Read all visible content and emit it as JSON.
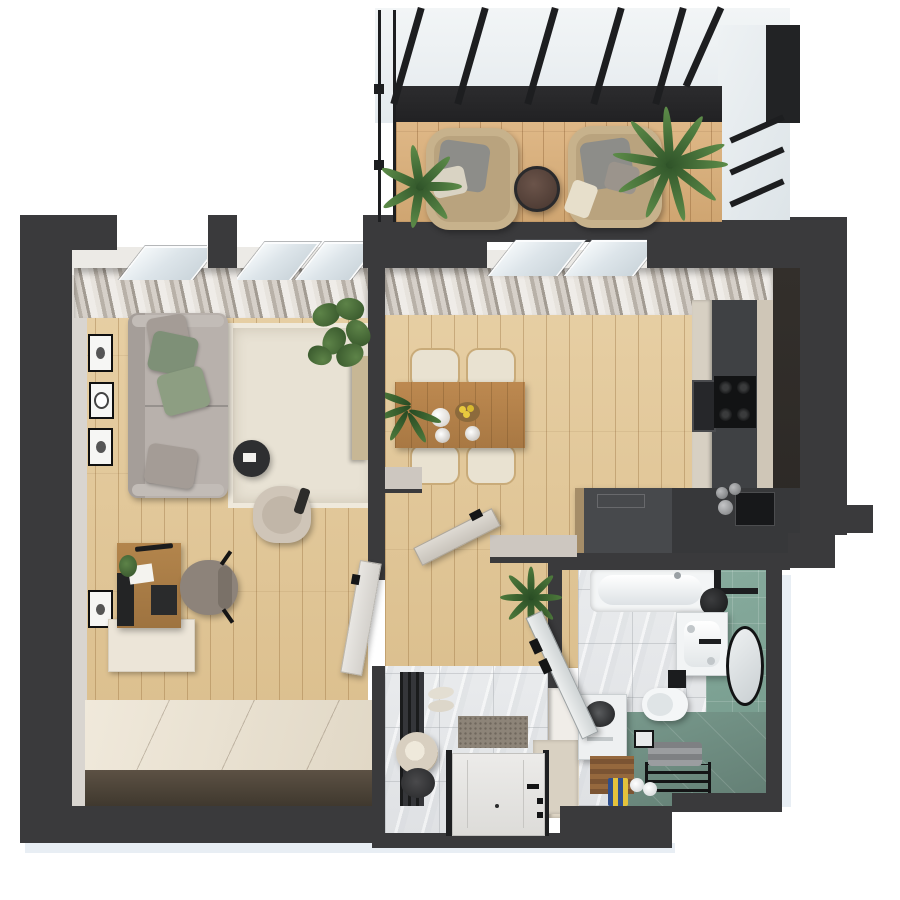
{
  "scene": {
    "type": "3d-top-down-floor-plan-render",
    "description_labels": {
      "balcony": "Balcony terrace with glazed pergola",
      "living": "Living room",
      "dining": "Dining area and kitchen",
      "hall": "Entrance hallway",
      "bath": "Bathroom",
      "study": "Work corner with platform"
    }
  },
  "palette": {
    "wall": "#3a3a3c",
    "wallLight": "#d9d5d0",
    "rug": "#e8e2d4",
    "sofa": "#b8b1ac",
    "pillowGreen": "#7e9077",
    "pillowGreen2": "#8d9e82",
    "pillowGray": "#a49c96",
    "diningTable": "#b5824a",
    "chairCream": "#e9e2d1",
    "cabinetDark": "#3f4144",
    "cabinetBeige": "#d7d0c3",
    "counterDark": "#37383a",
    "islandTop": "#47494c",
    "doorLight": "#e5e3e0",
    "rattan": "#c7b28c",
    "cushionGray": "#8d8d89",
    "sideTableBrown": "#5a453c",
    "hatCream": "#d8cfc0",
    "lemonYellow": "#e8c93e",
    "towelGray": "#8f9193",
    "duckboardBrown": "#8a5f3a",
    "blackFixture": "#1c1d1f",
    "ambientShadow": "#e8eef4"
  },
  "objects": {
    "balcony": [
      "pergola-glass-roof",
      "pergola-header-beam",
      "wicker-armchair-left",
      "wicker-armchair-right",
      "round-side-table",
      "palm-plant-left",
      "palm-plant-right"
    ],
    "living": [
      "tilted-window-1",
      "tilted-window-2",
      "sheer-curtains",
      "gray-sofa",
      "green-pillows",
      "area-rug",
      "round-coffee-table",
      "lounge-armchair",
      "tv-console",
      "monstera-plant",
      "wall-art-frames"
    ],
    "study": [
      "wooden-desk",
      "desk-monitor",
      "desk-keyboard",
      "desk-lamp",
      "office-chair",
      "return-cabinet",
      "podium-platform",
      "wall-art-frame"
    ],
    "dining": [
      "tilted-window-3",
      "sheer-curtains",
      "dining-table",
      "dining-chairs",
      "teapot",
      "lemon-bowl",
      "cups",
      "tall-cabinet-column",
      "dark-cabinet-run",
      "gas-cooktop",
      "built-in-oven",
      "kitchen-island",
      "counter-sink",
      "canisters"
    ],
    "hall": [
      "interior-door-study",
      "interior-door-dining",
      "entrance-door",
      "door-mat",
      "slippers",
      "coat-rack",
      "hats",
      "wardrobe",
      "fern-plant"
    ],
    "bath": [
      "bathtub",
      "shower-head",
      "glass-door",
      "vanity-sink",
      "round-mirror",
      "toilet",
      "flush-plate",
      "washing-machine",
      "wooden-duckboard",
      "towel-rack",
      "towels",
      "toiletries",
      "toilet-paper-holder"
    ]
  }
}
